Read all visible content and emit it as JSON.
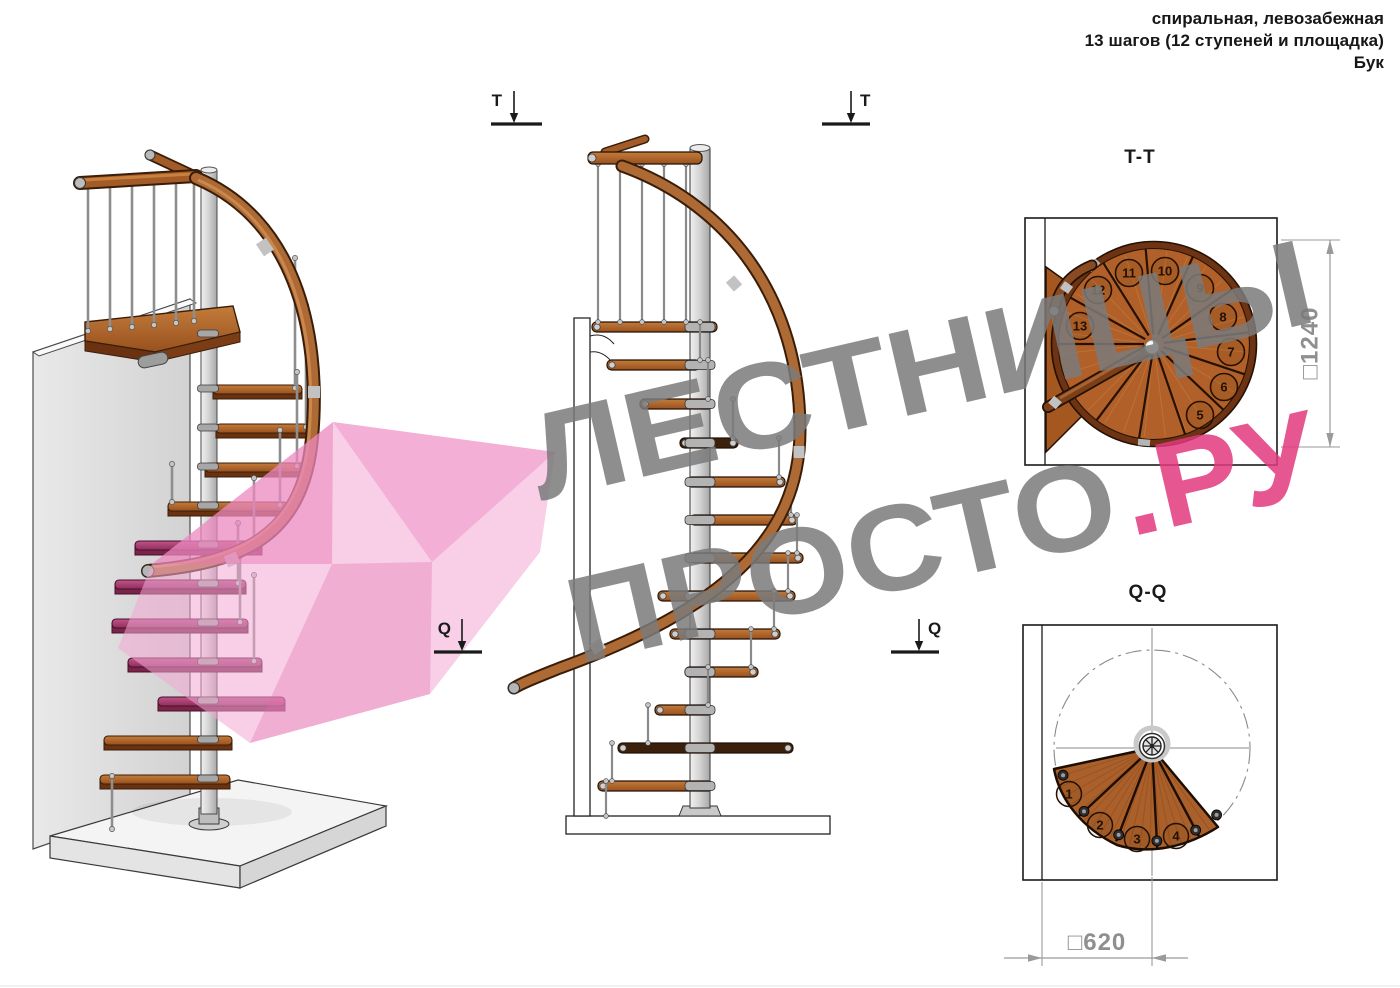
{
  "header": {
    "line1": "спиральная, левозабежная",
    "line2": "13 шагов (12 ступеней и площадка)",
    "line3": "Бук"
  },
  "markers": {
    "t": "T",
    "q": "Q"
  },
  "sections": {
    "tt": {
      "title": "T-T",
      "dimension": "□1240",
      "steps": [
        "5",
        "6",
        "7",
        "8",
        "9",
        "10",
        "11",
        "12",
        "13"
      ]
    },
    "qq": {
      "title": "Q-Q",
      "dimension": "□620",
      "steps": [
        "1",
        "2",
        "3",
        "4"
      ]
    }
  },
  "watermark": {
    "line1": "ЛЕСТНИЦЫ",
    "line2": "ПРОСТО",
    "suffix": ".РУ"
  },
  "colors": {
    "wood": "#a9602a",
    "wood_dark": "#6a3211",
    "metal": "#c9c9c9",
    "highlight_pink": "#f2a7d3",
    "accent_pink": "#e23a80",
    "watermark_gray": "#7b7b7b",
    "dimension_gray": "#8f8f8f",
    "line": "#1a1a1a"
  }
}
